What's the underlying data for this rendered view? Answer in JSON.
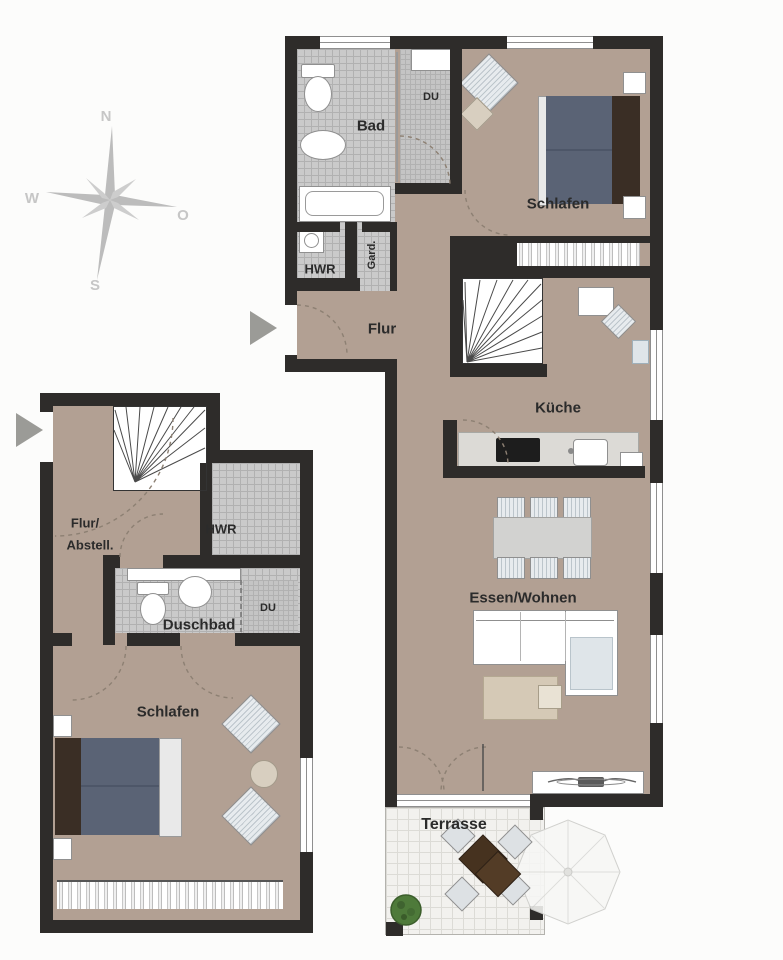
{
  "compass": {
    "n": "N",
    "e": "O",
    "s": "S",
    "w": "W"
  },
  "upper_unit": {
    "bad": "Bad",
    "du": "DU",
    "schlafen": "Schlafen",
    "hwr": "HWR",
    "gard": "Gard.",
    "flur": "Flur",
    "kueche": "Küche",
    "wohnen": "Essen/Wohnen",
    "terrasse": "Terrasse"
  },
  "lower_unit": {
    "flur1": "Flur/",
    "flur2": "Abstell.",
    "hwr": "HWR",
    "duschbad": "Duschbad",
    "du": "DU",
    "schlafen": "Schlafen"
  },
  "colors": {
    "floor": "#b2a093",
    "wall": "#2e2c2a",
    "tile": "#cacaca",
    "tile_line": "#b1b1b1",
    "terrace": "#f2f1ee",
    "terrace_line": "#dcdbd6",
    "bed_blue": "#5a6375",
    "headboard": "#3a2e25",
    "accent_blue": "#dfe5e9",
    "rug": "#d5c9b6",
    "plant": "#4e7a3a",
    "table_dark": "#46321f",
    "compass": "#c3c3c3",
    "label": "#2b2b2b",
    "arc": "#8d8073",
    "win_line": "#8f8f8f",
    "counter": "#dcdad6",
    "fringe": "#bdbdbd",
    "arrow": "#9b9b97"
  }
}
